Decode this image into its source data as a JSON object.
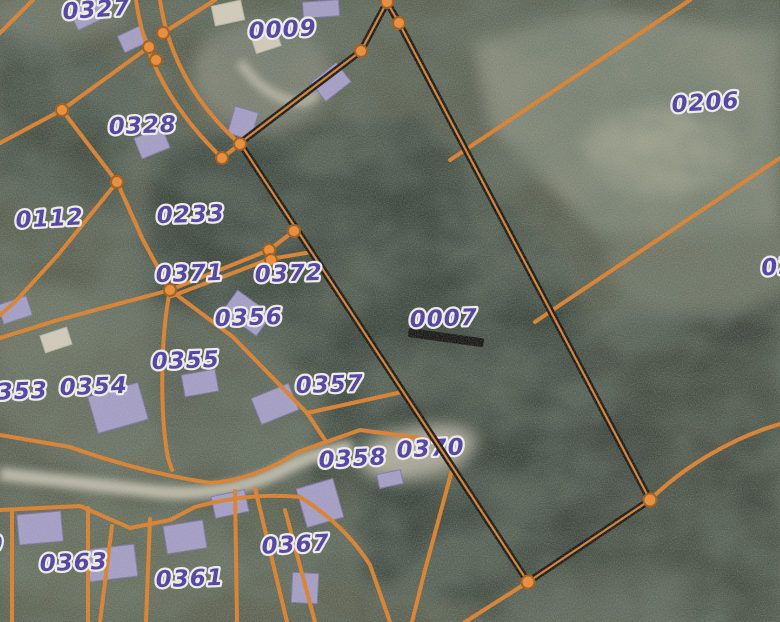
{
  "map": {
    "description": "Cadastral parcel boundary map overlaid on aerial photograph, parcel 0007 outlined in black",
    "highlighted_parcel_id": "0007",
    "parcel_labels": [
      {
        "id": "0327",
        "x": 97,
        "y": 17,
        "rot": -4
      },
      {
        "id": "0009",
        "x": 283,
        "y": 37,
        "rot": -3
      },
      {
        "id": "0206",
        "x": 706,
        "y": 110,
        "rot": -4
      },
      {
        "id": "0328",
        "x": 143,
        "y": 133,
        "rot": -2
      },
      {
        "id": "0112",
        "x": 50,
        "y": 226,
        "rot": -3
      },
      {
        "id": "0233",
        "x": 191,
        "y": 222,
        "rot": -2
      },
      {
        "id": "0371",
        "x": 190,
        "y": 281,
        "rot": -2
      },
      {
        "id": "0372",
        "x": 289,
        "y": 281,
        "rot": -2
      },
      {
        "id": "0356",
        "x": 249,
        "y": 325,
        "rot": -2
      },
      {
        "id": "0355",
        "x": 186,
        "y": 368,
        "rot": -2
      },
      {
        "id": "0353",
        "x": 14,
        "y": 399,
        "rot": -2,
        "partial": true
      },
      {
        "id": "0354",
        "x": 94,
        "y": 394,
        "rot": -2
      },
      {
        "id": "0007",
        "x": 444,
        "y": 326,
        "rot": -2
      },
      {
        "id": "0357",
        "x": 330,
        "y": 392,
        "rot": -2
      },
      {
        "id": "0370",
        "x": 431,
        "y": 456,
        "rot": -3,
        "under_highlight": true
      },
      {
        "id": "0358",
        "x": 353,
        "y": 466,
        "rot": -3
      },
      {
        "id": "0367",
        "x": 296,
        "y": 552,
        "rot": -3
      },
      {
        "id": "0363",
        "x": 74,
        "y": 570,
        "rot": -2
      },
      {
        "id": "0361",
        "x": 190,
        "y": 586,
        "rot": -2
      },
      {
        "id": "02",
        "x": 779,
        "y": 274,
        "rot": -6,
        "partial": true
      },
      {
        "id": "0",
        "x": -5,
        "y": 552,
        "rot": 0,
        "partial": true
      }
    ]
  },
  "colors": {
    "boundary_line": "#d97e2b",
    "vertex_fill": "#ea8a33",
    "vertex_ring": "#9e5816",
    "label_fill": "#4a3ba0",
    "label_halo": "#f0eeec",
    "highlight_outline": "#161616",
    "road": "#c8c3b3",
    "terrain_base": "#575d4e",
    "forest_dark": "#39423a",
    "field_light": "#8b9180",
    "building_lavender": "#a39cc4",
    "building_light": "#cfc9b8"
  }
}
